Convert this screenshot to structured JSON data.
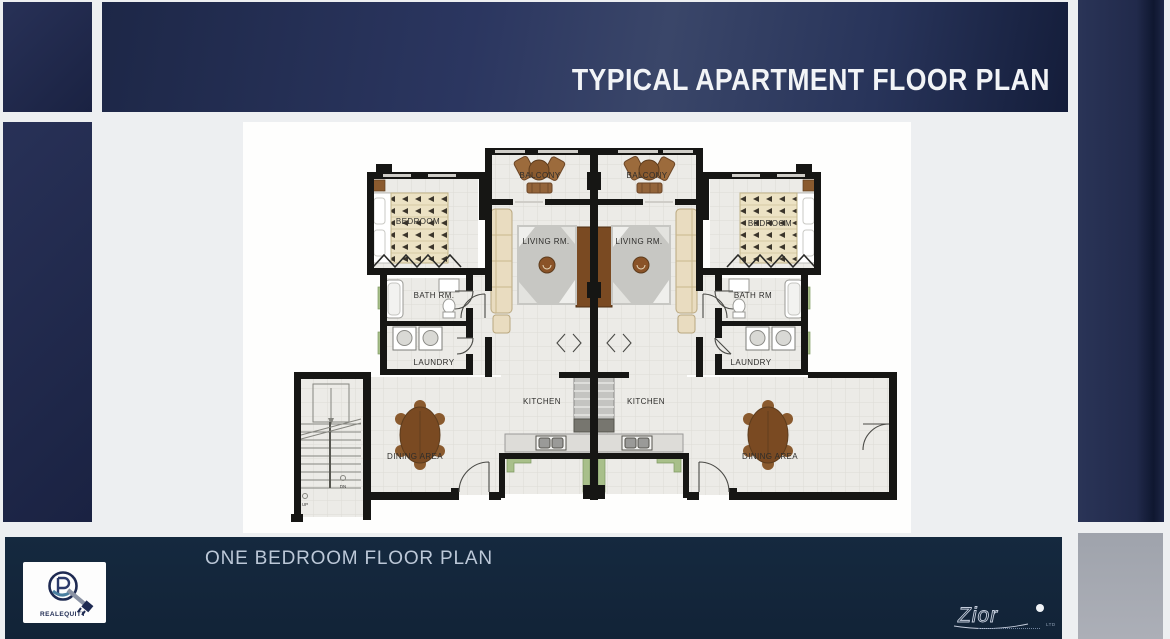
{
  "header": {
    "title": "TYPICAL APARTMENT FLOOR PLAN"
  },
  "footer": {
    "caption": "ONE BEDROOM FLOOR PLAN",
    "logo_text": "REALEQUITY",
    "signature": "Zior",
    "signature_suffix": "LTD"
  },
  "floor_plan": {
    "labels": {
      "balcony_left": "BALCONY",
      "balcony_right": "BALCONY",
      "bedroom_left": "BEDROOM",
      "bedroom_right": "BEDROOM",
      "living_left": "LIVING RM.",
      "living_right": "LIVING RM.",
      "bath_left": "BATH RM.",
      "bath_right": "BATH RM",
      "laundry_left": "LAUNDRY",
      "laundry_right": "LAUNDRY",
      "kitchen_left": "KITCHEN",
      "kitchen_right": "KITCHEN",
      "dining_left": "DINING AREA",
      "dining_right": "DINING AREA",
      "stairs_up": "UP",
      "stairs_dn": "DN"
    }
  },
  "colors": {
    "navy_accent": "#1d2747",
    "footer_navy": "#15293f",
    "wall_black": "#161614",
    "wood_brown": "#7a4a22",
    "planter_green": "#a8bf8a",
    "floor_gray": "#ecebe7"
  }
}
